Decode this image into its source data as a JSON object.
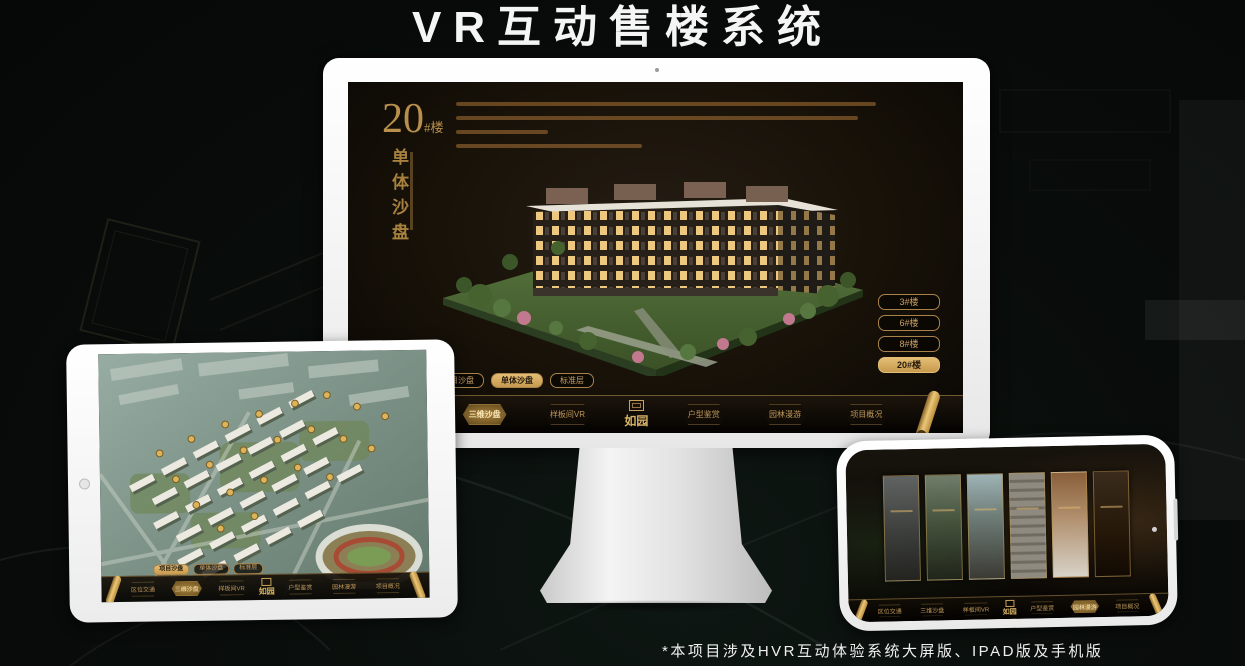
{
  "page": {
    "title": "VR互动售楼系统",
    "footnote": "*本项目涉及HVR互动体验系统大屏版、IPAD版及手机版"
  },
  "colors": {
    "accent_gold": "#c9a063",
    "active_gold": "#ddb266",
    "screen_background": "#171108",
    "title_text": "#f5f5f5"
  },
  "monitor_app": {
    "building_number": "20",
    "building_number_suffix": "#楼",
    "section_label_vertical": "单体沙盘",
    "floor_buttons": [
      {
        "label": "3#楼",
        "active": false
      },
      {
        "label": "6#楼",
        "active": false
      },
      {
        "label": "8#楼",
        "active": false
      },
      {
        "label": "20#楼",
        "active": true
      }
    ],
    "sub_tabs": [
      {
        "label": "项目沙盘",
        "active": false
      },
      {
        "label": "单体沙盘",
        "active": true
      },
      {
        "label": "标准层",
        "active": false
      }
    ],
    "nav_items": [
      {
        "label": "区位交通",
        "active": false
      },
      {
        "label": "三维沙盘",
        "active": true
      },
      {
        "label": "样板间VR",
        "active": false
      },
      {
        "label": "户型鉴赏",
        "active": false
      },
      {
        "label": "园林漫游",
        "active": false
      },
      {
        "label": "项目概况",
        "active": false
      }
    ],
    "logo": "如园"
  },
  "tablet_app": {
    "sub_tabs": [
      {
        "label": "项目沙盘",
        "active": true
      },
      {
        "label": "单体沙盘",
        "active": false
      },
      {
        "label": "标准层",
        "active": false
      }
    ],
    "nav_items": [
      {
        "label": "区位交通",
        "active": false
      },
      {
        "label": "三维沙盘",
        "active": true
      },
      {
        "label": "样板间VR",
        "active": false
      },
      {
        "label": "户型鉴赏",
        "active": false
      },
      {
        "label": "园林漫游",
        "active": false
      },
      {
        "label": "项目概况",
        "active": false
      }
    ],
    "logo": "如园"
  },
  "phone_app": {
    "nav_items": [
      {
        "label": "区位交通",
        "active": false
      },
      {
        "label": "三维沙盘",
        "active": false
      },
      {
        "label": "样板间VR",
        "active": false
      },
      {
        "label": "户型鉴赏",
        "active": false
      },
      {
        "label": "园林漫游",
        "active": true
      },
      {
        "label": "项目概况",
        "active": false
      }
    ],
    "logo": "如园"
  }
}
